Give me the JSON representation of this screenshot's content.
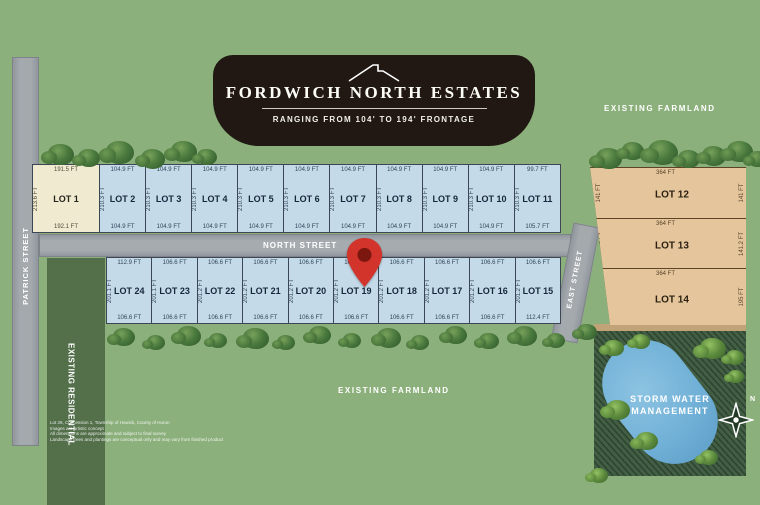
{
  "banner": {
    "title": "FORDWICH NORTH ESTATES",
    "subtitle": "RANGING FROM 104' TO 194' FRONTAGE"
  },
  "labels": {
    "patrick_street": "PATRICK STREET",
    "north_street": "NORTH STREET",
    "east_street": "EAST STREET",
    "farmland_top": "EXISTING FARMLAND",
    "farmland_bottom": "EXISTING FARMLAND",
    "residential": "EXISTING RESIDENTIAL",
    "storm": "STORM WATER MANAGEMENT"
  },
  "compass": {
    "n": "N"
  },
  "map_pin": {
    "target": "LOT 19"
  },
  "top_row": [
    {
      "name": "LOT 1",
      "top": "191.5 FT",
      "bottom": "192.1 FT",
      "side": "213.6 FT",
      "type": "cream"
    },
    {
      "name": "LOT 2",
      "top": "104.9 FT",
      "bottom": "104.9 FT",
      "side": "210.3 FT",
      "type": "blue"
    },
    {
      "name": "LOT 3",
      "top": "104.9 FT",
      "bottom": "104.9 FT",
      "side": "210.3 FT",
      "type": "blue"
    },
    {
      "name": "LOT 4",
      "top": "104.9 FT",
      "bottom": "104.9 FT",
      "side": "210.3 FT",
      "type": "blue"
    },
    {
      "name": "LOT 5",
      "top": "104.9 FT",
      "bottom": "104.9 FT",
      "side": "210.3 FT",
      "type": "blue"
    },
    {
      "name": "LOT 6",
      "top": "104.9 FT",
      "bottom": "104.9 FT",
      "side": "210.3 FT",
      "type": "blue"
    },
    {
      "name": "LOT 7",
      "top": "104.9 FT",
      "bottom": "104.9 FT",
      "side": "210.3 FT",
      "type": "blue"
    },
    {
      "name": "LOT 8",
      "top": "104.9 FT",
      "bottom": "104.9 FT",
      "side": "210.3 FT",
      "type": "blue"
    },
    {
      "name": "LOT 9",
      "top": "104.9 FT",
      "bottom": "104.9 FT",
      "side": "210.3 FT",
      "type": "blue"
    },
    {
      "name": "LOT 10",
      "top": "104.9 FT",
      "bottom": "104.9 FT",
      "side": "210.3 FT",
      "type": "blue"
    },
    {
      "name": "LOT 11",
      "top": "99.7 FT",
      "bottom": "105.7 FT",
      "side": "210.3 FT",
      "type": "blue"
    }
  ],
  "bottom_row": [
    {
      "name": "LOT 24",
      "top": "112.9 FT",
      "bottom": "106.6 FT",
      "side": "201.1 FT"
    },
    {
      "name": "LOT 23",
      "top": "106.6 FT",
      "bottom": "106.6 FT",
      "side": "201.1 FT"
    },
    {
      "name": "LOT 22",
      "top": "106.6 FT",
      "bottom": "106.6 FT",
      "side": "201.2 FT"
    },
    {
      "name": "LOT 21",
      "top": "106.6 FT",
      "bottom": "106.6 FT",
      "side": "201.2 FT"
    },
    {
      "name": "LOT 20",
      "top": "106.6 FT",
      "bottom": "106.6 FT",
      "side": "201.2 FT"
    },
    {
      "name": "LOT 19",
      "top": "106.6 FT",
      "bottom": "106.6 FT",
      "side": "201.2 FT"
    },
    {
      "name": "LOT 18",
      "top": "106.6 FT",
      "bottom": "106.6 FT",
      "side": "201.2 FT"
    },
    {
      "name": "LOT 17",
      "top": "106.6 FT",
      "bottom": "106.6 FT",
      "side": "201.2 FT"
    },
    {
      "name": "LOT 16",
      "top": "106.6 FT",
      "bottom": "106.6 FT",
      "side": "201.2 FT"
    },
    {
      "name": "LOT 15",
      "top": "106.6 FT",
      "bottom": "112.4 FT",
      "side": "201.2 FT"
    }
  ],
  "right_column": [
    {
      "name": "LOT 12",
      "top": "364 FT",
      "left": "141 FT",
      "right": "141 FT"
    },
    {
      "name": "LOT 13",
      "top": "364 FT",
      "left": "141.2 FT",
      "right": "141.2 FT"
    },
    {
      "name": "LOT 14",
      "top": "364 FT",
      "left": "194.9 FT",
      "right": "195 FT"
    }
  ],
  "disclaimer": {
    "lines": [
      "Lot 26, Concession 1, Township of Howick, County of Huron",
      "Images are artistic concept",
      "All dimensions are approximate and subject to final survey",
      "Landscape trees and plantings are conceptual only and may vary from finished product"
    ]
  },
  "colors": {
    "green": "#8cb07c",
    "banner": "#211713",
    "cream": "#f0ead0",
    "blue": "#c4dae8",
    "tan": "#e5c69c",
    "residential": "#53704b",
    "storm": "#3a573c",
    "pond": "#6fafd6",
    "pin": "#d2342c",
    "road": "#a4a9ae"
  }
}
